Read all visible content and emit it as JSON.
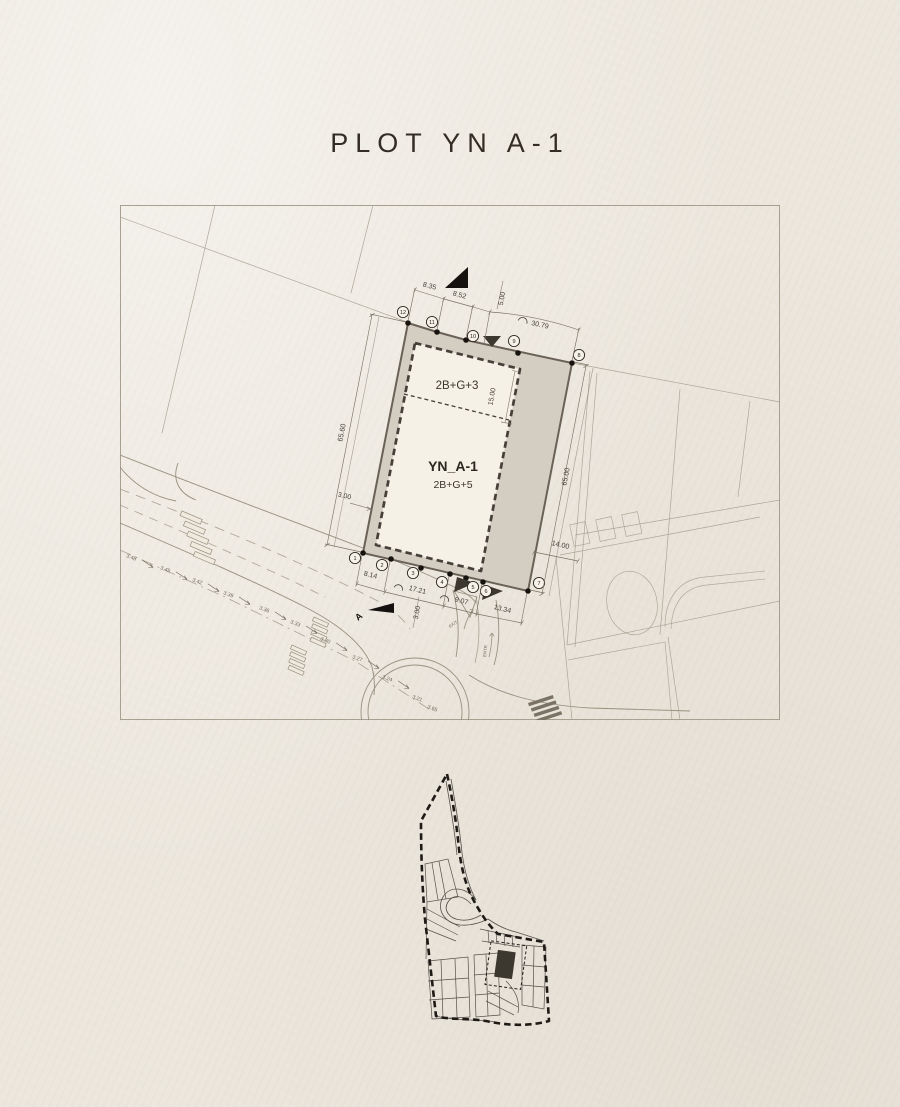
{
  "title": "PLOT YN A-1",
  "colors": {
    "paper": "#ece7dd",
    "frame_line": "#a79f90",
    "faint_line": "#a39b8c",
    "road_line": "#98907f",
    "plot_fill": "#d4cdc2",
    "plot_outline": "#6a6257",
    "building_fill": "#f6f1e6",
    "setback_dash": "#45403a",
    "ink": "#17140f",
    "marker_dark": "#3c372f"
  },
  "site_plan": {
    "plot_name": "YN_A-1",
    "plot_height": "2B+G+5",
    "annex_height": "2B+G+3",
    "section_label": "A",
    "vertex_numbers": [
      "1",
      "2",
      "3",
      "4",
      "5",
      "6",
      "7",
      "8",
      "9",
      "10",
      "11",
      "12"
    ],
    "dimensions": {
      "top_1": "8.35",
      "top_2": "8.52",
      "top_3": "5.00",
      "top_curve": "30.79",
      "left_side": "65.60",
      "left_setback": "3.00",
      "right_side": "65.00",
      "right_road": "14.00",
      "bottom_1": "8.14",
      "bottom_curve_1": "17.21",
      "bottom_curve_2": "9.07",
      "bottom_setback": "3.00",
      "bottom_2": "13.34",
      "annex_depth": "15.00"
    },
    "spot_elevations": [
      "3.48",
      "3.45",
      "3.42",
      "3.39",
      "3.36",
      "3.33",
      "3.30",
      "3.27",
      "3.24",
      "3.21",
      "3.65"
    ],
    "road_labels": {
      "exit": "EXIT",
      "entry": "ENTR"
    }
  }
}
